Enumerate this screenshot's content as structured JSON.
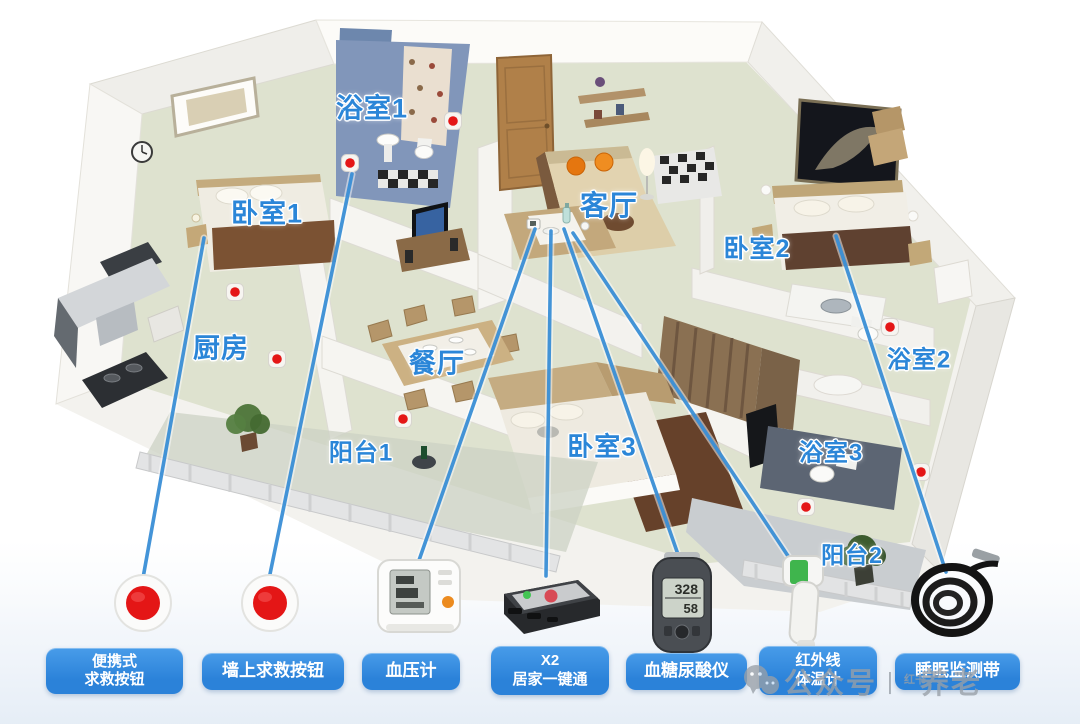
{
  "colors": {
    "label_blue": "#2b86d8",
    "pill_blue": "#2b82d9",
    "line_blue": "#3a8fd6",
    "sos_red": "#e41616",
    "watermark_gray": "#99a0a8"
  },
  "floorplan": {
    "rooms": [
      {
        "id": "bathroom-1",
        "label": "浴室1",
        "x": 372,
        "y": 106,
        "size": 27
      },
      {
        "id": "bedroom-1",
        "label": "卧室1",
        "x": 267,
        "y": 211,
        "size": 27
      },
      {
        "id": "living-room",
        "label": "客厅",
        "x": 609,
        "y": 204,
        "size": 28
      },
      {
        "id": "bedroom-2",
        "label": "卧室2",
        "x": 757,
        "y": 247,
        "size": 25
      },
      {
        "id": "kitchen",
        "label": "厨房",
        "x": 221,
        "y": 346,
        "size": 27
      },
      {
        "id": "dining-room",
        "label": "餐厅",
        "x": 437,
        "y": 361,
        "size": 27
      },
      {
        "id": "bathroom-2",
        "label": "浴室2",
        "x": 919,
        "y": 357,
        "size": 24
      },
      {
        "id": "balcony-1",
        "label": "阳台1",
        "x": 361,
        "y": 450,
        "size": 24
      },
      {
        "id": "bedroom-3",
        "label": "卧室3",
        "x": 602,
        "y": 445,
        "size": 26
      },
      {
        "id": "bathroom-3",
        "label": "浴室3",
        "x": 831,
        "y": 450,
        "size": 24
      },
      {
        "id": "balcony-2",
        "label": "阳台2",
        "x": 852,
        "y": 553,
        "size": 23
      }
    ],
    "sos_markers": [
      [
        350,
        163
      ],
      [
        453,
        121
      ],
      [
        235,
        292
      ],
      [
        277,
        359
      ],
      [
        403,
        419
      ],
      [
        890,
        327
      ],
      [
        806,
        507
      ],
      [
        921,
        472
      ]
    ],
    "connections": [
      {
        "from": [
          204,
          238
        ],
        "to": [
          143,
          578
        ]
      },
      {
        "from": [
          352,
          174
        ],
        "to": [
          269,
          579
        ]
      },
      {
        "from": [
          535,
          229
        ],
        "to": [
          417,
          566
        ]
      },
      {
        "from": [
          551,
          231
        ],
        "to": [
          546,
          576
        ]
      },
      {
        "from": [
          564,
          229
        ],
        "to": [
          681,
          563
        ]
      },
      {
        "from": [
          573,
          233
        ],
        "to": [
          800,
          574
        ]
      },
      {
        "from": [
          836,
          236
        ],
        "to": [
          946,
          572
        ]
      }
    ]
  },
  "devices": [
    {
      "id": "portable-sos-button",
      "line1": "便携式",
      "line2": "求救按钮"
    },
    {
      "id": "wall-sos-button",
      "line1": "墙上求救按钮"
    },
    {
      "id": "blood-pressure-monitor",
      "line1": "血压计"
    },
    {
      "id": "home-one-key-terminal",
      "line1": "X2",
      "line2": "居家一键通"
    },
    {
      "id": "glucose-uric-acid-meter",
      "line1": "血糖尿酸仪",
      "screen": [
        "328",
        "58"
      ]
    },
    {
      "id": "infrared-thermometer",
      "line1": "红外线",
      "line2": "体温计"
    },
    {
      "id": "sleep-monitor-band",
      "line1": "睡眠监测带"
    }
  ],
  "watermark": {
    "prefix": "公众号",
    "divider": "丨",
    "small_text": "红书",
    "suffix": "养老"
  }
}
